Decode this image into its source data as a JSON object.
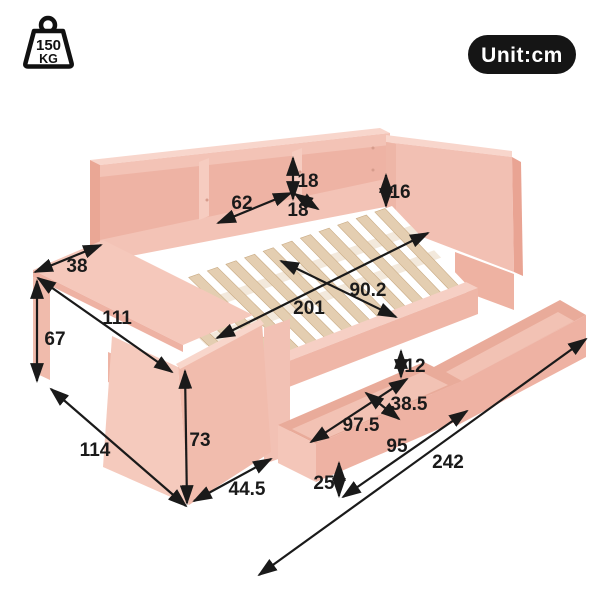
{
  "page": {
    "background": "#ffffff",
    "description": "Isometric dimension diagram of a pink daybed with back bookshelf rail, headboard, attached desk and two pull-out storage drawers"
  },
  "weight_badge": {
    "icon": "kettlebell-weight-icon",
    "value": "150",
    "unit": "KG"
  },
  "unit_badge": {
    "label": "Unit:cm"
  },
  "colors": {
    "frame_pink": "#f2c0b3",
    "frame_pink_light": "#f8d6cc",
    "frame_pink_mid": "#eeb3a4",
    "frame_pink_dark": "#e9a493",
    "slat_wood": "#e4ceb1",
    "slat_edge": "#c9ab84",
    "slat_support": "#f3e9dc",
    "annotation_ink": "#1a1a1a",
    "badge_background": "#151515",
    "badge_text": "#ffffff"
  },
  "dimensions_cm": [
    {
      "label": "18",
      "value": 18,
      "x1": 293,
      "y1": 158,
      "x2": 293,
      "y2": 199,
      "lx": 308,
      "ly": 187
    },
    {
      "label": "62",
      "value": 62,
      "x1": 218,
      "y1": 223,
      "x2": 291,
      "y2": 193,
      "lx": 242,
      "ly": 209
    },
    {
      "label": "18",
      "value": 18,
      "x1": 295,
      "y1": 194,
      "x2": 318,
      "y2": 209,
      "lx": 298,
      "ly": 216
    },
    {
      "label": "16",
      "value": 16,
      "x1": 386,
      "y1": 175,
      "x2": 386,
      "y2": 206,
      "lx": 400,
      "ly": 198
    },
    {
      "label": "38",
      "value": 38,
      "x1": 35,
      "y1": 272,
      "x2": 101,
      "y2": 245,
      "lx": 77,
      "ly": 272
    },
    {
      "label": "111",
      "value": 111,
      "x1": 38,
      "y1": 278,
      "x2": 172,
      "y2": 372,
      "lx": 117,
      "ly": 324
    },
    {
      "label": "67",
      "value": 67,
      "x1": 37,
      "y1": 281,
      "x2": 37,
      "y2": 381,
      "lx": 55,
      "ly": 345
    },
    {
      "label": "201",
      "value": 201,
      "x1": 217,
      "y1": 338,
      "x2": 428,
      "y2": 233,
      "lx": 309,
      "ly": 314
    },
    {
      "label": "90.2",
      "value": 90.2,
      "x1": 281,
      "y1": 261,
      "x2": 396,
      "y2": 317,
      "lx": 368,
      "ly": 296
    },
    {
      "label": "12",
      "value": 12,
      "x1": 401,
      "y1": 351,
      "x2": 401,
      "y2": 377,
      "lx": 415,
      "ly": 372
    },
    {
      "label": "38.5",
      "value": 38.5,
      "x1": 366,
      "y1": 393,
      "x2": 399,
      "y2": 419,
      "lx": 409,
      "ly": 410
    },
    {
      "label": "97.5",
      "value": 97.5,
      "x1": 311,
      "y1": 442,
      "x2": 407,
      "y2": 379,
      "lx": 361,
      "ly": 431
    },
    {
      "label": "95",
      "value": 95,
      "x1": 343,
      "y1": 497,
      "x2": 467,
      "y2": 411,
      "lx": 397,
      "ly": 452
    },
    {
      "label": "25",
      "value": 25,
      "x1": 339,
      "y1": 463,
      "x2": 339,
      "y2": 496,
      "lx": 324,
      "ly": 489
    },
    {
      "label": "242",
      "value": 242,
      "x1": 259,
      "y1": 575,
      "x2": 586,
      "y2": 339,
      "lx": 448,
      "ly": 468
    },
    {
      "label": "114",
      "value": 114,
      "x1": 51,
      "y1": 389,
      "x2": 186,
      "y2": 506,
      "lx": 95,
      "ly": 456
    },
    {
      "label": "73",
      "value": 73,
      "x1": 185,
      "y1": 371,
      "x2": 187,
      "y2": 503,
      "lx": 200,
      "ly": 446
    },
    {
      "label": "44.5",
      "value": 44.5,
      "x1": 194,
      "y1": 501,
      "x2": 271,
      "y2": 459,
      "lx": 247,
      "ly": 495
    }
  ]
}
